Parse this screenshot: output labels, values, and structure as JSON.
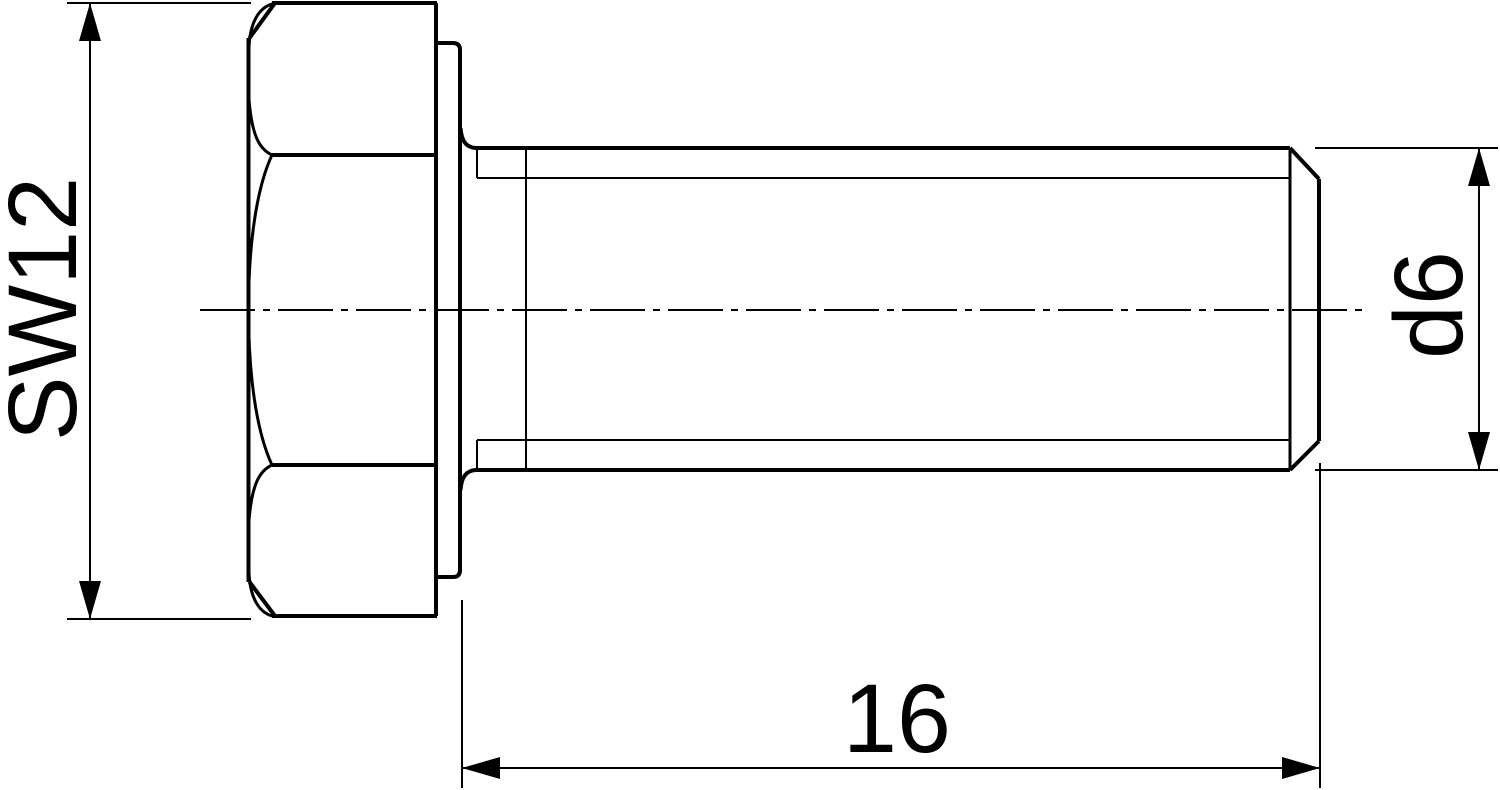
{
  "canvas": {
    "width": 1500,
    "height": 790,
    "background": "#ffffff",
    "line_color": "#000000"
  },
  "dimensions": {
    "across_flats": {
      "label": "SW12",
      "orientation": "vertical"
    },
    "diameter": {
      "label": "d6",
      "orientation": "vertical"
    },
    "length": {
      "label": "16",
      "orientation": "horizontal"
    }
  },
  "geometry": {
    "lines": [
      {
        "name": "head-top-edge",
        "cls": "w4",
        "x1": 272,
        "y1": 3,
        "x2": 437,
        "y2": 3
      },
      {
        "name": "head-bottom-edge",
        "cls": "w4",
        "x1": 272,
        "y1": 616,
        "x2": 437,
        "y2": 616
      },
      {
        "name": "head-right-edge",
        "cls": "w4",
        "x1": 436,
        "y1": 3,
        "x2": 436,
        "y2": 616
      },
      {
        "name": "head-left-edge",
        "cls": "w4",
        "x1": 248.5,
        "y1": 38,
        "x2": 248.5,
        "y2": 582
      },
      {
        "name": "head-top-left-chamfer",
        "cls": "w4",
        "x1": 275,
        "y1": 3,
        "x2": 249.5,
        "y2": 38
      },
      {
        "name": "head-bottom-left-chamfer",
        "cls": "w4",
        "x1": 249.5,
        "y1": 582,
        "x2": 275,
        "y2": 616
      },
      {
        "name": "head-facet-line-top",
        "cls": "w4",
        "x1": 272,
        "y1": 155,
        "x2": 436,
        "y2": 155
      },
      {
        "name": "head-facet-line-bottom",
        "cls": "w4",
        "x1": 272,
        "y1": 465,
        "x2": 436,
        "y2": 465
      },
      {
        "name": "washer-face-top-edge",
        "cls": "w4",
        "x1": 437,
        "y1": 43,
        "x2": 453,
        "y2": 43
      },
      {
        "name": "washer-face-bottom-edge",
        "cls": "w4",
        "x1": 437,
        "y1": 577,
        "x2": 453,
        "y2": 577
      },
      {
        "name": "washer-face-right-edge",
        "cls": "w4",
        "x1": 460,
        "y1": 50,
        "x2": 460,
        "y2": 570
      },
      {
        "name": "shank-crest-top-line",
        "cls": "w4",
        "x1": 475,
        "y1": 148,
        "x2": 1290,
        "y2": 148
      },
      {
        "name": "shank-crest-bottom-line",
        "cls": "w4",
        "x1": 475,
        "y1": 470,
        "x2": 1290,
        "y2": 470
      },
      {
        "name": "thread-end-line",
        "cls": "w3",
        "x1": 1290,
        "y1": 148,
        "x2": 1290,
        "y2": 470
      },
      {
        "name": "tip-chamfer-top",
        "cls": "w4",
        "x1": 1290,
        "y1": 148,
        "x2": 1319,
        "y2": 179
      },
      {
        "name": "tip-chamfer-bottom",
        "cls": "w4",
        "x1": 1290,
        "y1": 470,
        "x2": 1319,
        "y2": 441
      },
      {
        "name": "tip-end-face",
        "cls": "w4",
        "x1": 1319,
        "y1": 179,
        "x2": 1319,
        "y2": 441
      },
      {
        "name": "thread-root-top-line",
        "cls": "w2",
        "x1": 477,
        "y1": 178,
        "x2": 1290,
        "y2": 178
      },
      {
        "name": "thread-root-bottom-line",
        "cls": "w2",
        "x1": 477,
        "y1": 440,
        "x2": 1290,
        "y2": 440
      },
      {
        "name": "thread-root-tick-top",
        "cls": "w2",
        "x1": 477,
        "y1": 150,
        "x2": 477,
        "y2": 178
      },
      {
        "name": "thread-root-tick-bottom",
        "cls": "w2",
        "x1": 477,
        "y1": 440,
        "x2": 477,
        "y2": 468
      },
      {
        "name": "thread-runout-line",
        "cls": "w2",
        "x1": 526,
        "y1": 150,
        "x2": 526,
        "y2": 468
      },
      {
        "name": "centerline",
        "cls": "center",
        "x1": 200,
        "y1": 310,
        "x2": 1363,
        "y2": 310
      },
      {
        "name": "sw-extension-top",
        "cls": "w2",
        "x1": 67,
        "y1": 3,
        "x2": 251,
        "y2": 3
      },
      {
        "name": "sw-extension-bottom",
        "cls": "w2",
        "x1": 67,
        "y1": 619,
        "x2": 251,
        "y2": 619
      },
      {
        "name": "sw-dimension-line",
        "cls": "w2",
        "x1": 90,
        "y1": 3,
        "x2": 90,
        "y2": 619
      },
      {
        "name": "d6-extension-top",
        "cls": "w2",
        "x1": 1315,
        "y1": 148,
        "x2": 1498,
        "y2": 148
      },
      {
        "name": "d6-extension-bottom",
        "cls": "w2",
        "x1": 1315,
        "y1": 470,
        "x2": 1498,
        "y2": 470
      },
      {
        "name": "d6-dimension-line",
        "cls": "w2",
        "x1": 1479,
        "y1": 148,
        "x2": 1479,
        "y2": 470
      },
      {
        "name": "length-extension-left",
        "cls": "w2",
        "x1": 462,
        "y1": 600,
        "x2": 462,
        "y2": 788
      },
      {
        "name": "length-extension-right",
        "cls": "w2",
        "x1": 1320,
        "y1": 463,
        "x2": 1320,
        "y2": 788
      },
      {
        "name": "length-dimension-line",
        "cls": "w2",
        "x1": 462,
        "y1": 768,
        "x2": 1320,
        "y2": 768
      }
    ],
    "paths": [
      {
        "name": "head-chamfer-arc-top-outer",
        "cls": "w3",
        "d": "M 249,47 C 250,24 258,7 274,3.5"
      },
      {
        "name": "head-chamfer-arc-top-inner",
        "cls": "w3",
        "d": "M 249,100 C 252,135 259,149 272,155"
      },
      {
        "name": "head-chamfer-arc-middle",
        "cls": "w3",
        "d": "M 272,155 C 256,189 248.5,247 248.5,310 C 248.5,373 256,431 272,465"
      },
      {
        "name": "head-chamfer-arc-bottom-inner",
        "cls": "w3",
        "d": "M 272,465 C 259,471 252,485 249,520"
      },
      {
        "name": "head-chamfer-arc-bottom-outer",
        "cls": "w3",
        "d": "M 249,573 C 250,596 258,613 274,616.5"
      },
      {
        "name": "washer-face-corner-top",
        "cls": "w4",
        "d": "M 453,43 Q 460,43 460,50"
      },
      {
        "name": "washer-face-corner-bottom",
        "cls": "w4",
        "d": "M 460,570 Q 460,577 453,577"
      },
      {
        "name": "under-head-fillet-top",
        "cls": "w4",
        "d": "M 460.5,128 C 461.5,141 466,147.5 476,148"
      },
      {
        "name": "under-head-fillet-bottom",
        "cls": "w4",
        "d": "M 460.5,490 C 461.5,477 466,470.5 476,470"
      }
    ],
    "polygons": [
      {
        "name": "sw-arrowhead-up",
        "points": "90,3 79,41 101,41"
      },
      {
        "name": "sw-arrowhead-down",
        "points": "90,619 79,581 101,581"
      },
      {
        "name": "d6-arrowhead-up",
        "points": "1479,148 1468,186 1490,186"
      },
      {
        "name": "d6-arrowhead-down",
        "points": "1479,470 1468,432 1490,432"
      },
      {
        "name": "length-arrowhead-left",
        "points": "462,768 500,757 500,779"
      },
      {
        "name": "length-arrowhead-right",
        "points": "1320,768 1282,757 1282,779"
      }
    ],
    "texts": [
      {
        "name": "across-flats-label",
        "bind": "dimensions.across_flats.label",
        "transform": "translate(76,309) rotate(-90)"
      },
      {
        "name": "diameter-label",
        "bind": "dimensions.diameter.label",
        "transform": "translate(1462,305) rotate(-90)"
      },
      {
        "name": "length-label",
        "bind": "dimensions.length.label",
        "transform": "translate(897,752)"
      }
    ]
  }
}
